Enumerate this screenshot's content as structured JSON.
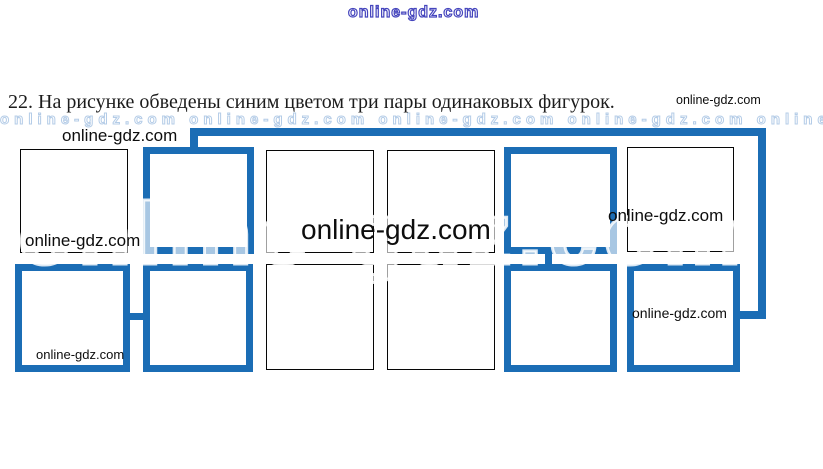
{
  "header": {
    "top_watermark": "online-gdz.com",
    "title": "22. На рисунке обведены синим цветом три пары одинаковых фигурок.",
    "title_suffix_watermark": "online-gdz.com"
  },
  "watermarks": {
    "above_figure": "online-gdz.com",
    "inside_box_r1c1": "online-gdz.com",
    "center_large": "online-gdz.com",
    "right_row1": "online-gdz.com",
    "inside_box_r2c6": "online-gdz.com",
    "inside_box_r2c1": "online-gdz.com",
    "ghost_large": "online-gdz.com",
    "ghost_row": "online-gdz.com online-gdz.com online-gdz.com online-gdz.com online-gdz.com online-gdz.com"
  },
  "figure": {
    "accent_color": "#1b6db5",
    "plain_border_color": "#060606",
    "grid": {
      "rows": 2,
      "cols": 6
    },
    "boxes": [
      {
        "id": "r1c1",
        "outlined": false
      },
      {
        "id": "r1c2",
        "outlined": true
      },
      {
        "id": "r1c3",
        "outlined": false
      },
      {
        "id": "r1c4",
        "outlined": false
      },
      {
        "id": "r1c5",
        "outlined": true
      },
      {
        "id": "r1c6",
        "outlined": false
      },
      {
        "id": "r2c1",
        "outlined": true
      },
      {
        "id": "r2c2",
        "outlined": true
      },
      {
        "id": "r2c3",
        "outlined": false
      },
      {
        "id": "r2c4",
        "outlined": false
      },
      {
        "id": "r2c5",
        "outlined": true
      },
      {
        "id": "r2c6",
        "outlined": true
      }
    ],
    "pairs": [
      [
        "r1c2",
        "r2c6"
      ],
      [
        "r2c1",
        "r2c2"
      ],
      [
        "r1c5",
        "r2c5"
      ]
    ]
  }
}
